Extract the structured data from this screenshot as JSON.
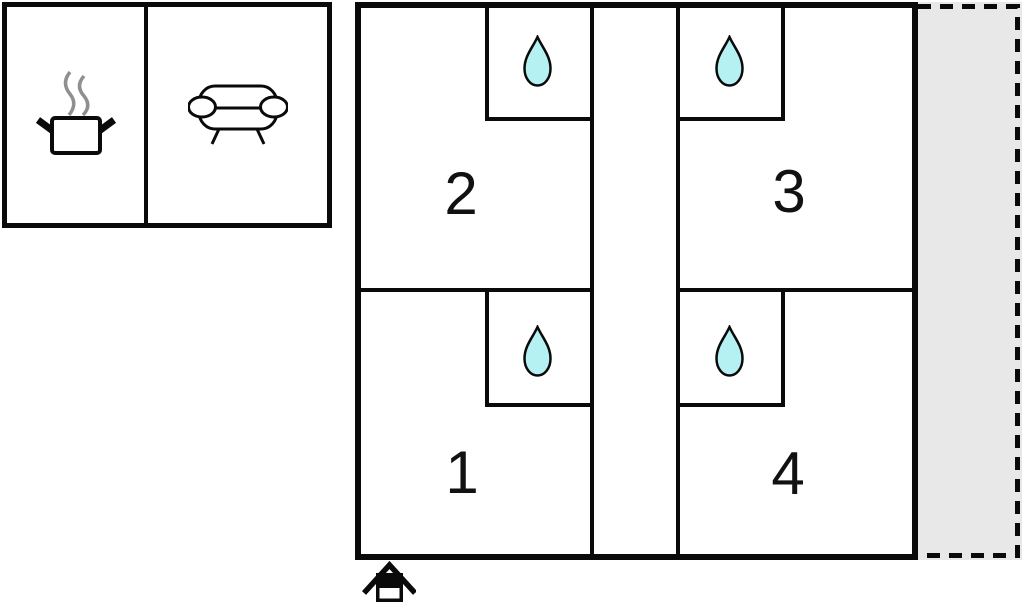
{
  "colors": {
    "wall": "#0a0a0a",
    "drop_fill": "#b5f1f3",
    "terrace_fill": "#e8e8e8",
    "steam": "#8f8f8f",
    "background": "#ffffff"
  },
  "amenity_block": {
    "items": [
      {
        "name": "kitchen",
        "icon": "cooking-pot-icon"
      },
      {
        "name": "living-room",
        "icon": "sofa-icon"
      }
    ]
  },
  "building": {
    "rooms": [
      {
        "number": "1",
        "water_icon": "water-drop-icon"
      },
      {
        "number": "2",
        "water_icon": "water-drop-icon"
      },
      {
        "number": "3",
        "water_icon": "water-drop-icon"
      },
      {
        "number": "4",
        "water_icon": "water-drop-icon"
      }
    ]
  },
  "terrace": {
    "name": "terrace",
    "border_style": "dashed"
  },
  "entrance": {
    "icon": "entrance-house-icon"
  }
}
